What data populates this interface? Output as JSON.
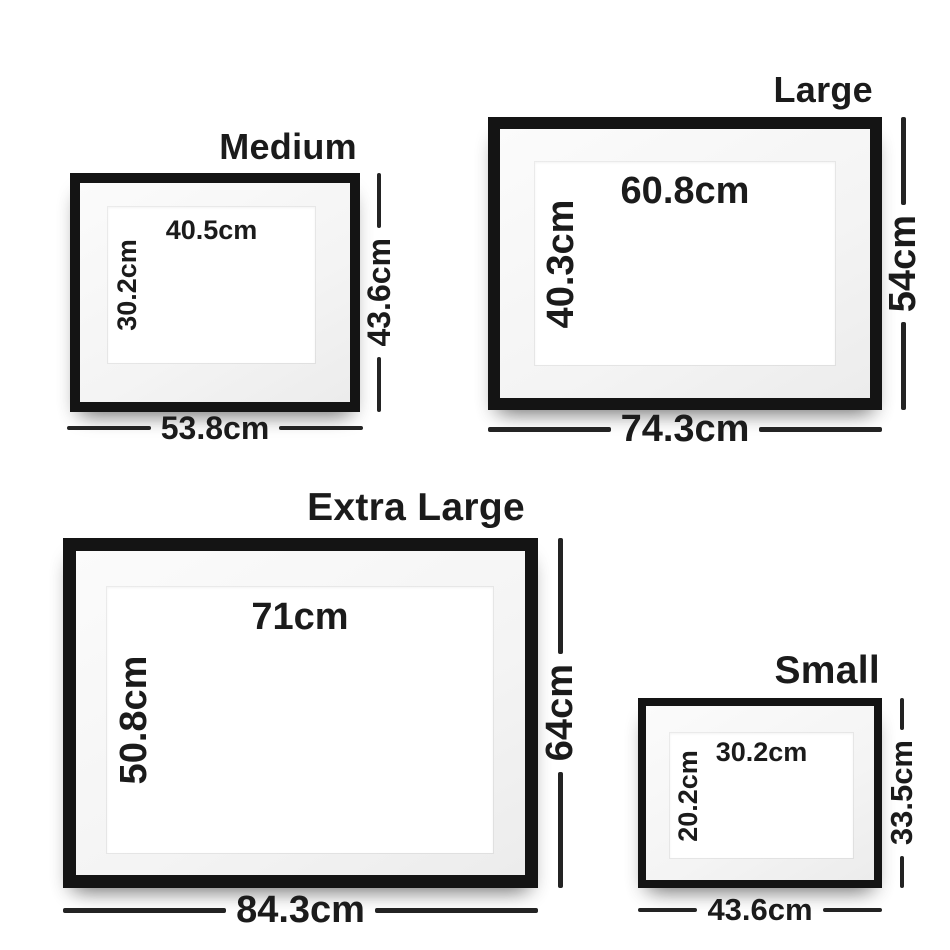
{
  "title": "Frame size guide",
  "colors": {
    "frame_black": "#141414",
    "mat": "#f4f4f4",
    "opening_white": "#ffffff",
    "text": "#1b1b1b",
    "dimension_line": "#232323",
    "background": "#ffffff"
  },
  "frames": [
    {
      "name": "medium",
      "title": "Medium",
      "print_width": "40.5cm",
      "print_height": "30.2cm",
      "frame_height": "43.6cm",
      "frame_width": "53.8cm"
    },
    {
      "name": "large",
      "title": "Large",
      "print_width": "60.8cm",
      "print_height": "40.3cm",
      "frame_height": "54cm",
      "frame_width": "74.3cm"
    },
    {
      "name": "extra-large",
      "title": "Extra Large",
      "print_width": "71cm",
      "print_height": "50.8cm",
      "frame_height": "64cm",
      "frame_width": "84.3cm"
    },
    {
      "name": "small",
      "title": "Small",
      "print_width": "30.2cm",
      "print_height": "20.2cm",
      "frame_height": "33.5cm",
      "frame_width": "43.6cm"
    }
  ]
}
